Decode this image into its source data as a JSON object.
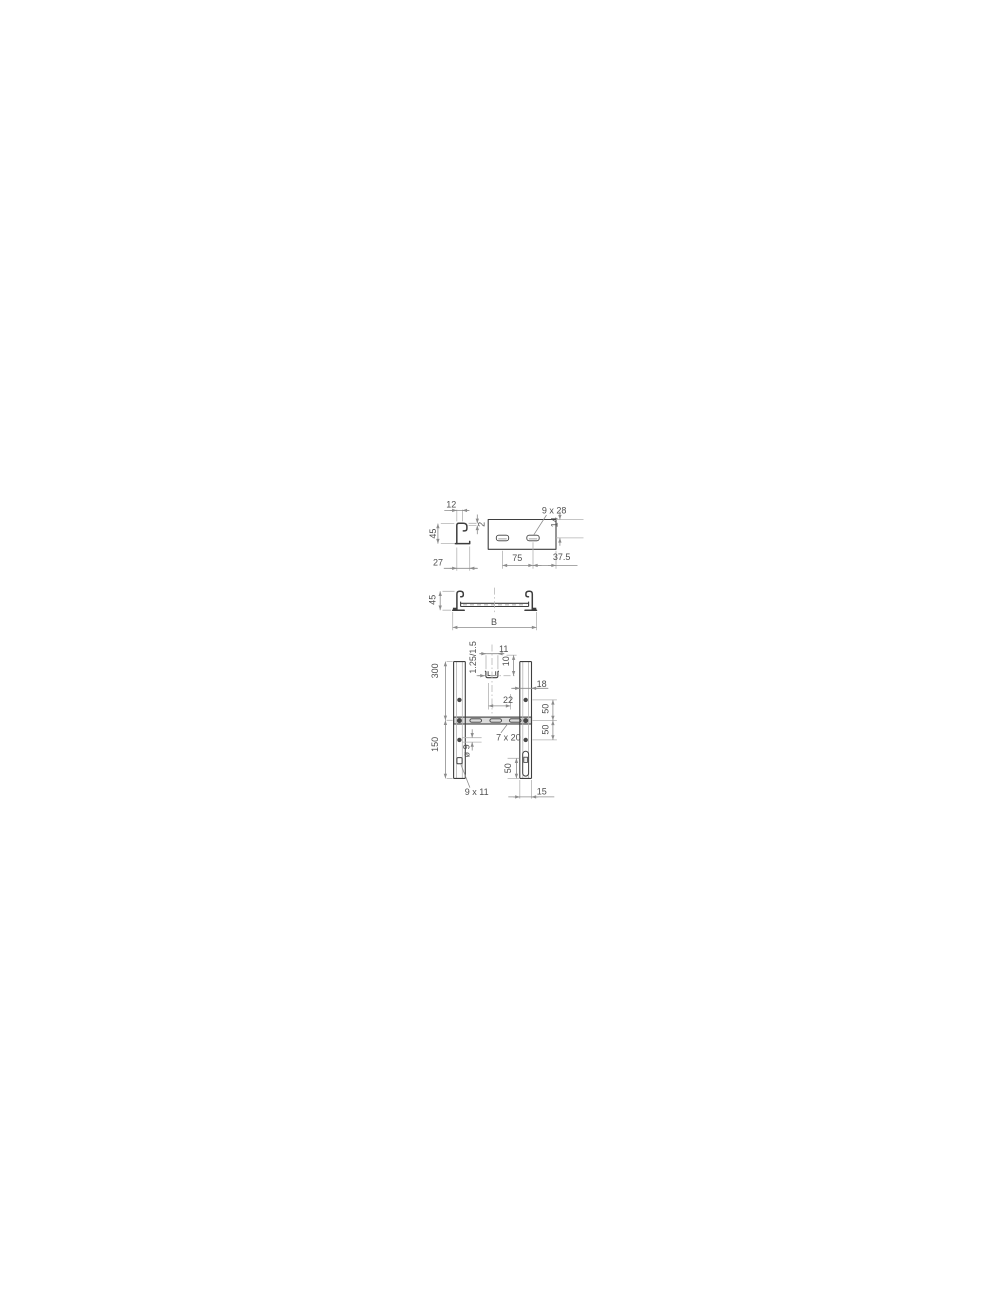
{
  "drawing": {
    "subject": "Cable ladder technical drawing",
    "colors": {
      "line": "#3d3d3d",
      "dimension": "#8c8c8c",
      "extension": "#b3b3b3",
      "text": "#4f4f4f",
      "rung_fill": "#dcdcdc"
    },
    "views": {
      "rail_profile": {
        "dim_lip": "12",
        "dim_height": "45",
        "dim_thickness": "2",
        "dim_base": "27"
      },
      "rung_face": {
        "label_slot": "9 x 28",
        "dim_top_offset": "14",
        "dim_slot_pitch": "75",
        "dim_end_offset": "37.5"
      },
      "ladder_section": {
        "dim_height": "45",
        "dim_width": "B"
      },
      "ladder_plan": {
        "label_gauge": "1.25/1.5",
        "dim_detail_width": "11",
        "dim_detail_height": "10",
        "dim_rail_flange": "18",
        "dim_slot_pitch": "22",
        "dim_rung_pitch": "300",
        "dim_hole_pitch": "150",
        "dim_hole_offset_upper": "50",
        "dim_hole_offset_lower": "50",
        "label_rung_slot": "7 x 20",
        "label_hole_dia": "ø 9",
        "label_rail_slot": "9 x 11",
        "dim_fixing_slot": "50",
        "dim_rail_depth": "15"
      }
    }
  }
}
